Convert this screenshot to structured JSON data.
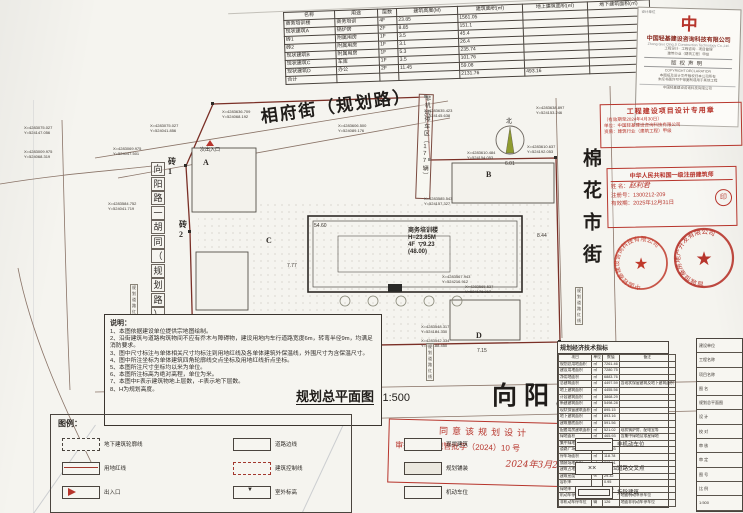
{
  "area_table": {
    "headers": [
      "名称",
      "用途",
      "层数",
      "建筑高度(M)",
      "建筑面积(㎡)",
      "地上建筑面积(㎡)",
      "地下建筑面积(㎡)"
    ],
    "rows": [
      [
        "商务培训楼",
        "商务培训",
        "4F",
        "23.85",
        "1561.05",
        "",
        ""
      ],
      [
        "现状建筑A",
        "锅炉房",
        "2F",
        "8.85",
        "151.1",
        "",
        ""
      ],
      [
        "砖1",
        "附属用房",
        "1F",
        "3.5",
        "45.4",
        "",
        ""
      ],
      [
        "砖2",
        "附属用房",
        "1F",
        "3.1",
        "26.4",
        "",
        ""
      ],
      [
        "现状建筑B",
        "附属用房",
        "1F",
        "5.3",
        "235.74",
        "",
        ""
      ],
      [
        "现状建筑C",
        "车库",
        "1F",
        "3.5",
        "101.76",
        "",
        ""
      ],
      [
        "现状建筑D",
        "办公",
        "2F",
        "11.45",
        "59.08",
        "",
        ""
      ]
    ],
    "total": [
      "合计",
      "",
      "",
      "",
      "2131.76",
      "493.16",
      ""
    ]
  },
  "company": {
    "top_line": "设计单位",
    "logo_glyph": "中",
    "name_cn": "中国轻基建设咨询科技有限公司",
    "name_en": "Zhong Guo Qing Ji Construction Technology Co.,Ltd.",
    "info_lines": [
      "工程设计 · 工程咨询 · 项目管理",
      "建筑行业（建筑工程）甲级"
    ],
    "copyright_title": "版权声明",
    "copyright_en": "COPYRIGHT DECLARATION",
    "copyright_lines": [
      "本图纸及设计文件版权归本公司所有",
      "未经书面许可不得复制或用于其他工程"
    ],
    "bottom_line": "中国轻基建设咨询科技有限公司"
  },
  "stamp_design": {
    "title": "工程建设项目设计专用章",
    "line1": "（有效期至2024年4月30日）",
    "line2": "单位：中国轻基建设咨询科技有限公司",
    "line3": "资质：建筑行业（建筑工程）甲级"
  },
  "stamp_architect": {
    "title": "中华人民共和国一级注册建筑师",
    "name_label": "姓  名：",
    "name": "赵利君",
    "reg_label": "注册号：",
    "reg": "1300212-209",
    "valid_label": "有效期：",
    "valid": "2025年12月31日",
    "seal_glyph": "印"
  },
  "seals": {
    "left_ring": "中国轻基建设咨询科技有限公司",
    "right_ring": "晋城恒基房地产开发有限公司",
    "star": "★"
  },
  "streets": {
    "top": "相府街（规划路）",
    "right": "棉花市街",
    "bottom": "向阳路",
    "left_vertical": "向阳路一胡同（规划路）"
  },
  "plan": {
    "building": {
      "name": "商务培训楼",
      "height": "H=23.85M",
      "floors": "4F",
      "elev": "9.23",
      "alt": "(48.00)"
    },
    "parking_strip": "非机动停车区（177辆）",
    "main_entrance": "主出入口",
    "sub_entrance": "次出入口",
    "compass": "北",
    "redline_label": "规划道路红线",
    "redline_positions": [
      {
        "x": 130,
        "y": 284
      },
      {
        "x": 575,
        "y": 287
      },
      {
        "x": 426,
        "y": 343
      }
    ],
    "letters": [
      {
        "x": 203,
        "y": 158,
        "t": "A"
      },
      {
        "x": 486,
        "y": 170,
        "t": "B"
      },
      {
        "x": 266,
        "y": 236,
        "t": "C"
      },
      {
        "x": 476,
        "y": 331,
        "t": "D"
      },
      {
        "x": 168,
        "y": 156,
        "t": "砖1"
      },
      {
        "x": 179,
        "y": 219,
        "t": "砖2"
      }
    ],
    "coords": [
      {
        "x": 150,
        "y": 124,
        "a": "X=4283075.027",
        "b": "Y=524041.856"
      },
      {
        "x": 113,
        "y": 147,
        "a": "X=4283069.975",
        "b": "Y=524047.501"
      },
      {
        "x": 222,
        "y": 110,
        "a": "X=4283636.709",
        "b": "Y=524068.192"
      },
      {
        "x": 338,
        "y": 124,
        "a": "X=4283606.500",
        "b": "Y=524089.176"
      },
      {
        "x": 424,
        "y": 109,
        "a": "X=4283635.423",
        "b": "Y=524145.638"
      },
      {
        "x": 536,
        "y": 106,
        "a": "X=4283638.897",
        "b": "Y=524153.246"
      },
      {
        "x": 467,
        "y": 151,
        "a": "X=4283610.484",
        "b": "Y=524154.053"
      },
      {
        "x": 527,
        "y": 145,
        "a": "X=4283610.637",
        "b": "Y=524192.053"
      },
      {
        "x": 424,
        "y": 197,
        "a": "X=4283585.543",
        "b": "Y=524157.327"
      },
      {
        "x": 442,
        "y": 275,
        "a": "X=4283567.943",
        "b": "Y=524216.912"
      },
      {
        "x": 465,
        "y": 285,
        "a": "X=4283565.537",
        "b": "Y=524176.917"
      },
      {
        "x": 421,
        "y": 325,
        "a": "X=4283548.317",
        "b": "Y=524184.330"
      },
      {
        "x": 421,
        "y": 339,
        "a": "X=4283542.334",
        "b": "Y=524188.450"
      },
      {
        "x": 108,
        "y": 202,
        "a": "X=4283584.752",
        "b": "Y=524041.719"
      },
      {
        "x": 24,
        "y": 126,
        "a": "X=4283075.027",
        "b": "Y=524147.056"
      },
      {
        "x": 24,
        "y": 150,
        "a": "X=4283009.975",
        "b": "Y=524068.319"
      }
    ],
    "dims": [
      {
        "x": 314,
        "y": 223,
        "t": "54.60"
      },
      {
        "x": 167,
        "y": 317,
        "t": "13.00"
      },
      {
        "x": 293,
        "y": 314,
        "t": "8.95"
      },
      {
        "x": 287,
        "y": 263,
        "t": "7.77"
      },
      {
        "x": 337,
        "y": 336,
        "t": "6.05"
      },
      {
        "x": 477,
        "y": 348,
        "t": "7.15"
      },
      {
        "x": 505,
        "y": 161,
        "t": "6.01"
      },
      {
        "x": 537,
        "y": 233,
        "t": "8.44"
      }
    ]
  },
  "notes": {
    "title": "说明：",
    "items": [
      "1、本图依据建设单位提供宗地图绘制。",
      "2、沿街建筑与道路构筑物间不应有乔木与障碍物，建设用地内车行道路宽度6m，转弯半径9m，均满足消防要求。",
      "3、图中尺寸标注与单体相关尺寸均标注到用地红线及各单体建筑外保温线，外围尺寸为含保温尺寸。",
      "4、图中所注坐标为单体建筑四角轮廓线交点坐标及用地红线折点坐标。",
      "5、本图所注尺寸坐标均以米为单位。",
      "6、本图所注标高为绝对高程，单位为米。",
      "7、本图中F表示建筑物地上层数，-F表示地下层数。",
      "8、H为规划高度。"
    ]
  },
  "legend": {
    "title": "图例：",
    "items": [
      {
        "swatch": "dashed",
        "label": "地下建筑轮廓线"
      },
      {
        "swatch": "redline",
        "label": "用地红线"
      },
      {
        "swatch": "entrance",
        "label": "出入口"
      },
      {
        "swatch": "plain",
        "label": "道路边线"
      },
      {
        "swatch": "reddash",
        "label": "建筑控制线"
      },
      {
        "swatch": "elev",
        "label": "室外标高"
      },
      {
        "swatch": "plain",
        "label": "现状建筑"
      },
      {
        "swatch": "light",
        "label": "规划铺装"
      },
      {
        "swatch": "plain",
        "label": "机动车位"
      },
      {
        "swatch": "bar",
        "label": "非机动车位"
      },
      {
        "swatch": "cross",
        "label": "道路交叉点"
      },
      {
        "swatch": "double",
        "label": "拆除建筑"
      }
    ]
  },
  "drawing_title": {
    "name": "规划总平面图",
    "scale": "1:500"
  },
  "approval": {
    "line1": "同意该规划设计",
    "line2": "审批号：高规管批字（2024）10 号",
    "line3": "2024年3月26日"
  },
  "indicator_table": {
    "title": "规划经济技术指标",
    "headers": [
      "项目",
      "单位",
      "数值",
      "备注"
    ],
    "rows": [
      [
        "规划总用地面积",
        "㎡",
        "7261.46",
        ""
      ],
      [
        "建设用地面积",
        "㎡",
        "7280.75",
        ""
      ],
      [
        "净用地面积",
        "㎡",
        "6883.76",
        ""
      ],
      [
        "总建筑面积",
        "㎡",
        "4497.59",
        "含现状保留建筑及地下建筑面积"
      ],
      [
        "地上建筑面积",
        "㎡",
        "4455.56",
        ""
      ],
      [
        "计容建筑面积",
        "㎡",
        "3868.29",
        ""
      ],
      [
        "新建建筑面积",
        "㎡",
        "5498.28",
        ""
      ],
      [
        "现状保留建筑面积",
        "㎡",
        "895.15",
        ""
      ],
      [
        "地下建筑面积",
        "㎡",
        "893.16",
        ""
      ],
      [
        "建筑基底面积",
        "㎡",
        "591.56",
        ""
      ],
      [
        "配套用房建筑面积",
        "㎡",
        "521.02",
        "现状锅炉房、配电室等"
      ],
      [
        "绿地面积",
        "㎡",
        "465.93",
        "含集中绿地及零星绿地"
      ],
      [
        "集中绿地面积",
        "㎡",
        "28.91",
        ""
      ],
      [
        "道路广场面积",
        "㎡",
        "138.93",
        ""
      ],
      [
        "停车场面积",
        "㎡",
        "118.78",
        ""
      ],
      [
        "铺装场地面积",
        "㎡",
        "263.01",
        ""
      ],
      [
        "建筑占地面积",
        "㎡",
        "2011.36",
        ""
      ],
      [
        "建筑密度",
        "%",
        "29.32",
        ""
      ],
      [
        "容积率",
        "",
        "0.95",
        ""
      ],
      [
        "绿地率",
        "%",
        "58.03",
        ""
      ],
      [
        "机动车停车位",
        "辆",
        "94",
        "地面机动车停车位"
      ],
      [
        "非机动车停车位",
        "辆",
        "126",
        "地面非机动车停车位"
      ]
    ]
  },
  "titleblock": {
    "rows": [
      "建设单位",
      "工程名称",
      "项目名称",
      "图 名",
      "规划总平面图",
      "设 计",
      "校 对",
      "审 核",
      "审 定",
      "图 号",
      "比 例",
      "1:500"
    ]
  }
}
